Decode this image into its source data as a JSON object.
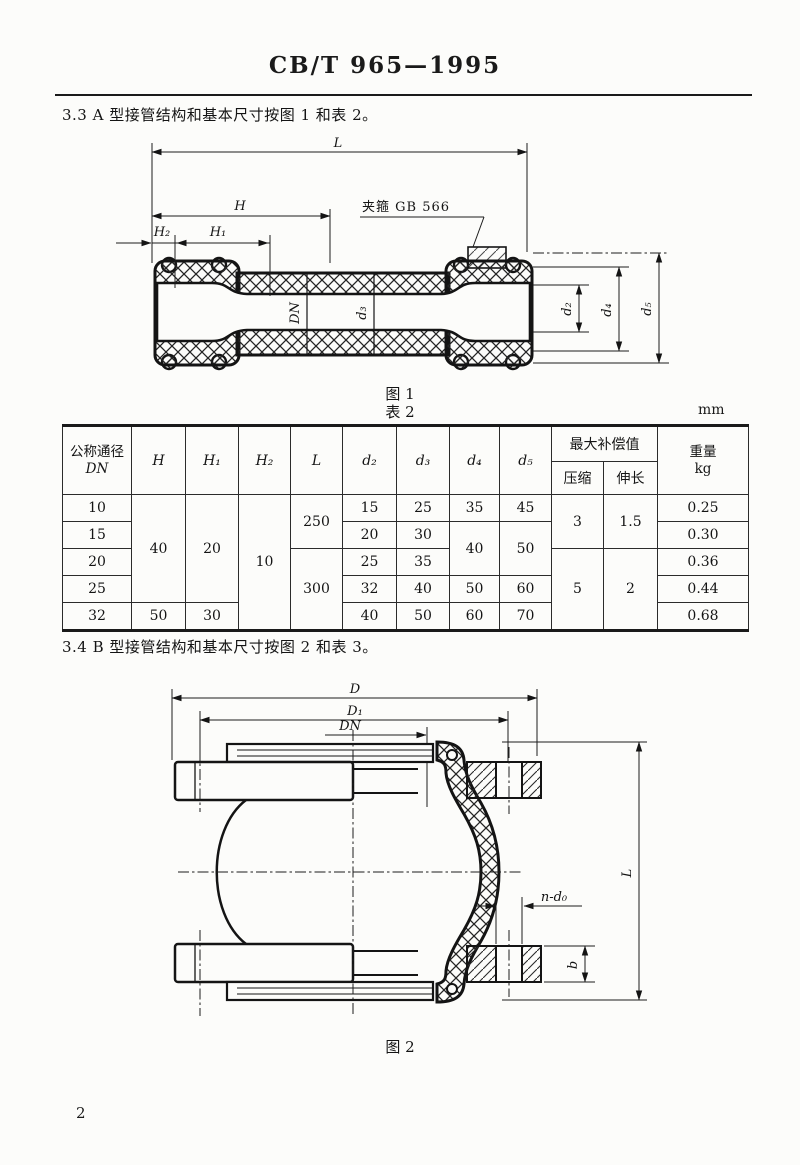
{
  "header": {
    "standard_code": "CB/T 965—1995"
  },
  "sections": {
    "s33": "3.3  A 型接管结构和基本尺寸按图 1 和表 2。",
    "s34": "3.4  B 型接管结构和基本尺寸按图 2 和表 3。"
  },
  "figure1": {
    "caption": "图 1",
    "labels": {
      "L": "L",
      "H": "H",
      "H1": "H₁",
      "H2": "H₂",
      "clamp": "夹箍 GB 566",
      "DN": "DN",
      "d2": "d₂",
      "d3": "d₃",
      "d4": "d₄",
      "d5": "d₅"
    }
  },
  "table2": {
    "caption": "表 2",
    "unit": "mm",
    "header": {
      "dn_label": "公称通径",
      "dn_sym": "DN",
      "h": "H",
      "h1": "H₁",
      "h2": "H₂",
      "l": "L",
      "d2": "d₂",
      "d3": "d₃",
      "d4": "d₄",
      "d5": "d₅",
      "comp": "最大补偿值",
      "comp_compress": "压缩",
      "comp_extend": "伸长",
      "weight": "重量",
      "weight_unit": "kg"
    },
    "cells": {
      "r1": {
        "dn": "10",
        "h": "40",
        "h1": "20",
        "h2": "10",
        "l": "250",
        "d2": "15",
        "d3": "25",
        "d4": "35",
        "d5": "45",
        "compress": "3",
        "extend": "1.5",
        "w": "0.25"
      },
      "r2": {
        "dn": "15",
        "d2": "20",
        "d3": "30",
        "d4": "40",
        "d5": "50",
        "w": "0.30"
      },
      "r3": {
        "dn": "20",
        "l": "300",
        "d2": "25",
        "d3": "35",
        "compress": "5",
        "extend": "2",
        "w": "0.36"
      },
      "r4": {
        "dn": "25",
        "d2": "32",
        "d3": "40",
        "d4": "50",
        "d5": "60",
        "w": "0.44"
      },
      "r5": {
        "dn": "32",
        "h": "50",
        "h1": "30",
        "d2": "40",
        "d3": "50",
        "d4": "60",
        "d5": "70",
        "w": "0.68"
      }
    }
  },
  "figure2": {
    "caption": "图 2",
    "labels": {
      "D": "D",
      "D1": "D₁",
      "DN": "DN",
      "L": "L",
      "n_d0": "n-d₀",
      "b": "b"
    }
  },
  "page": {
    "number": "2"
  }
}
